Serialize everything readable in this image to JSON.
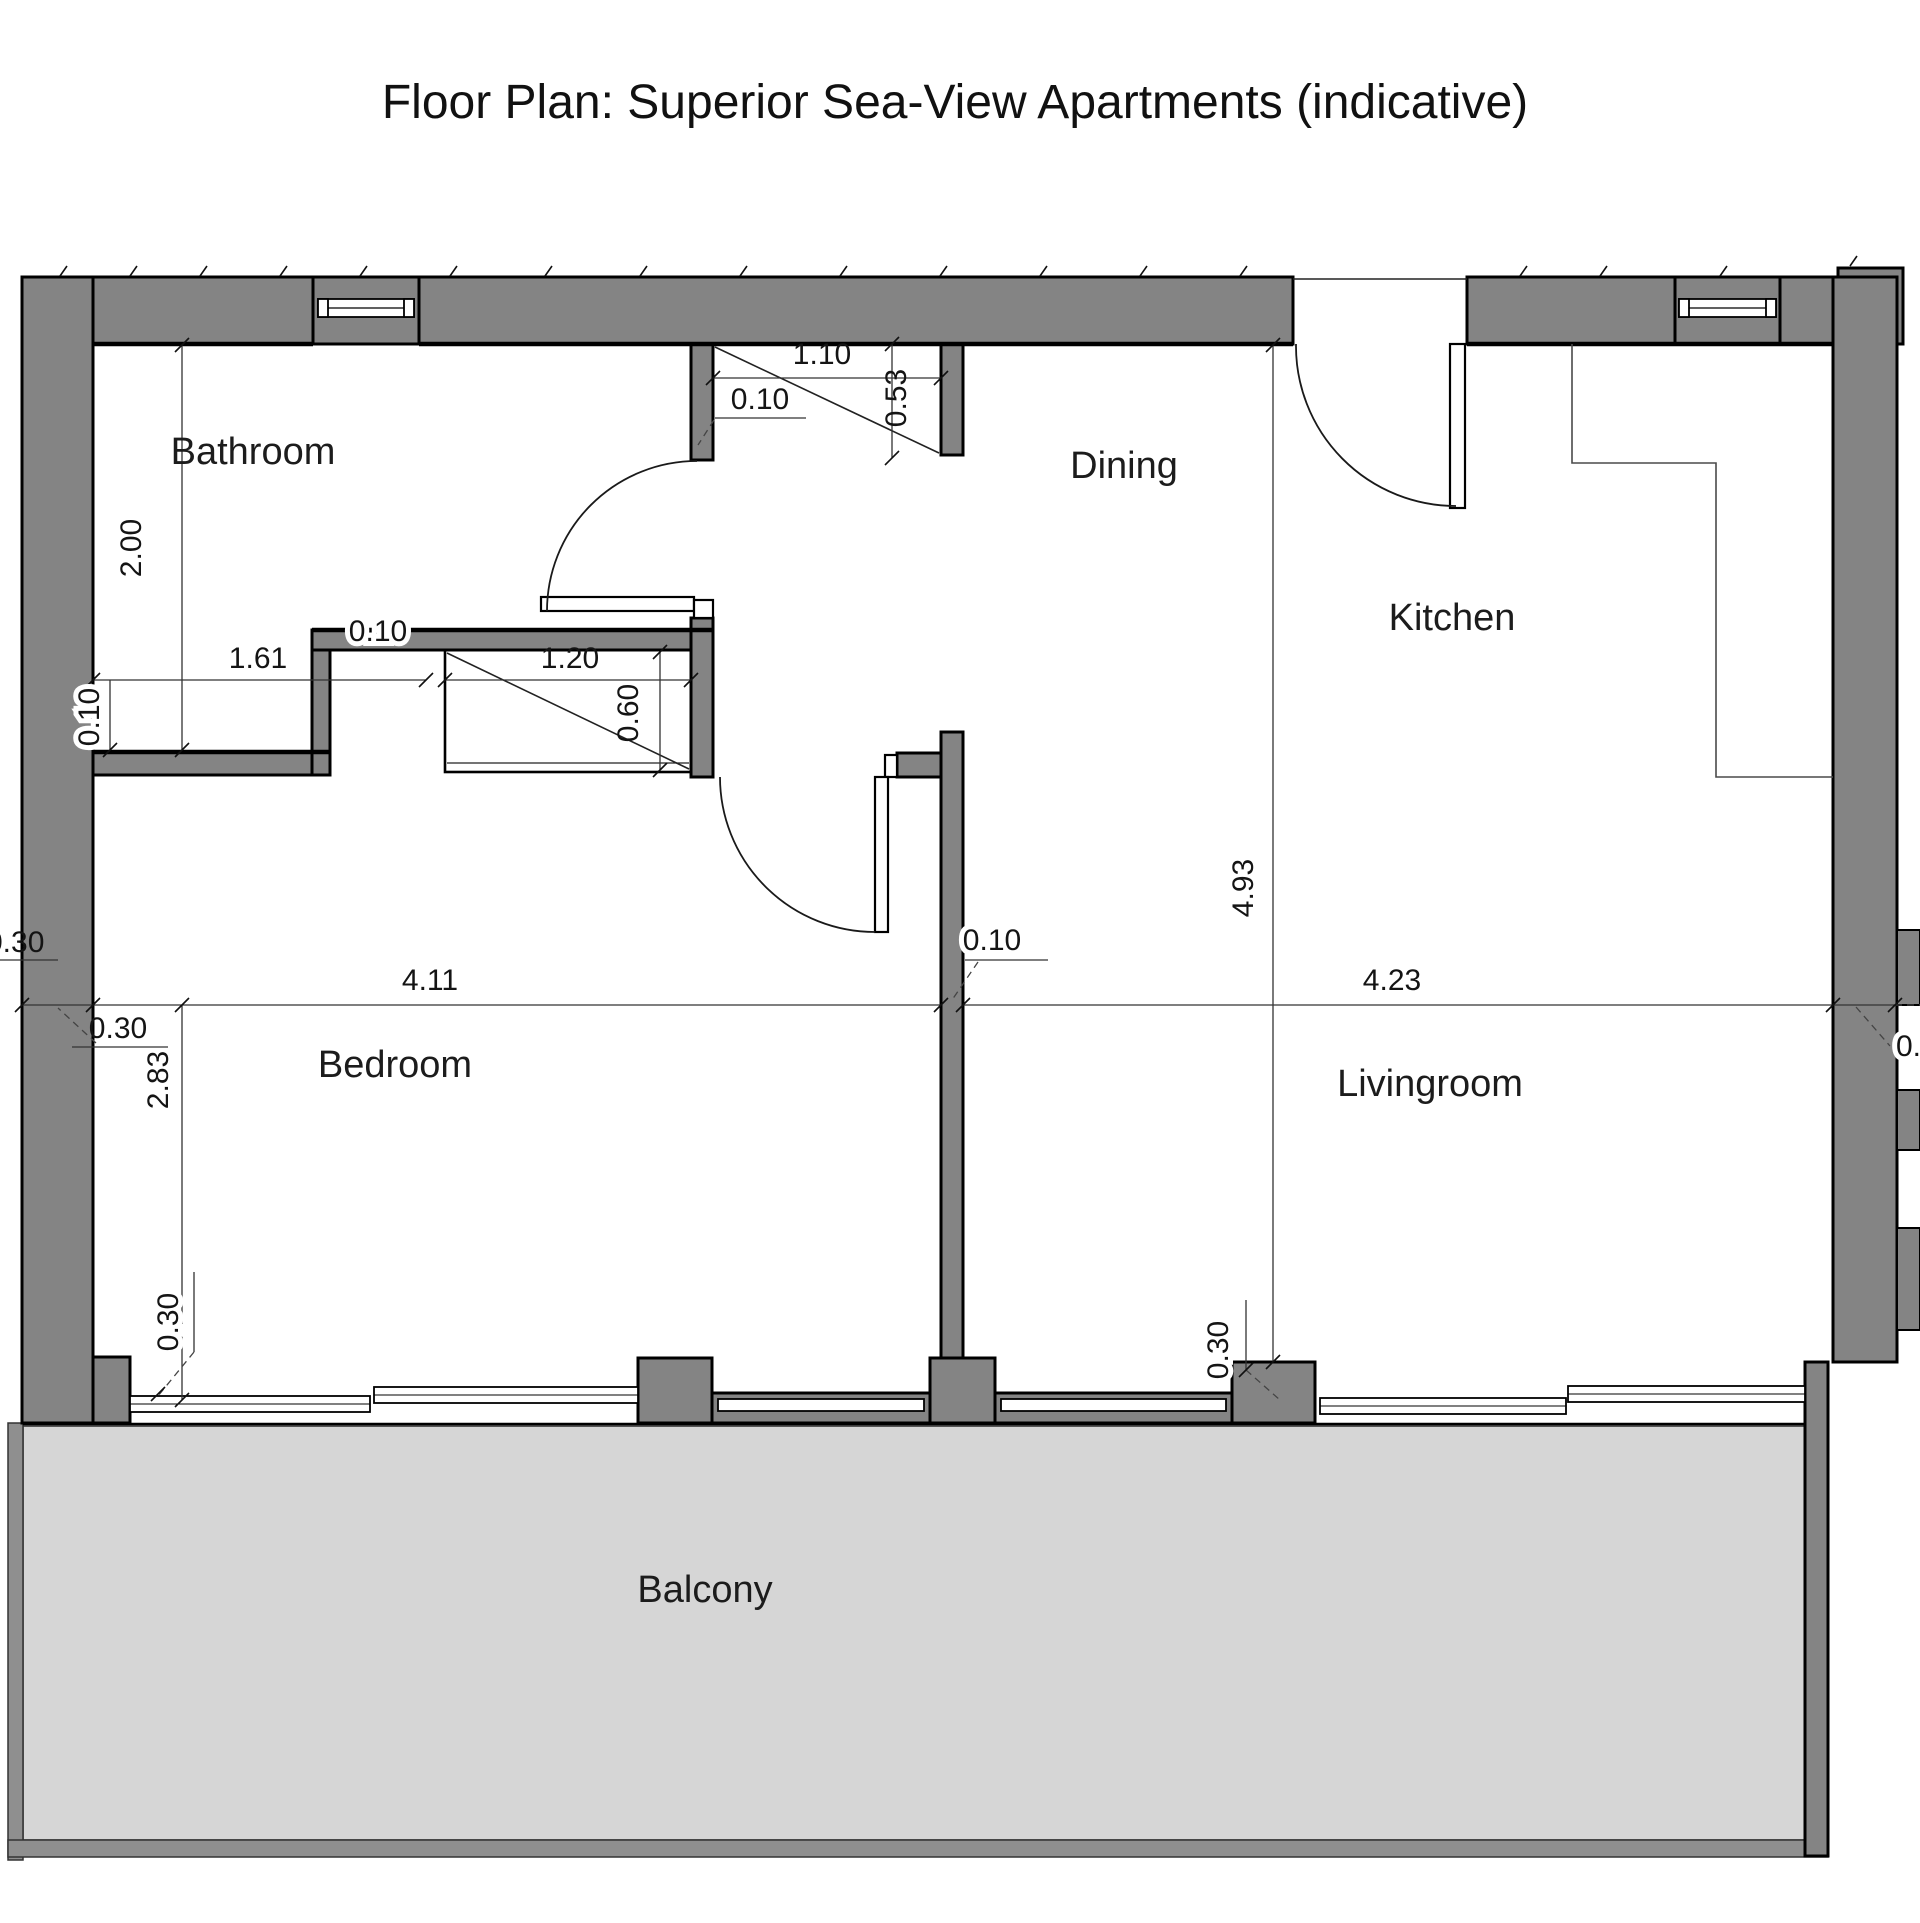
{
  "title": "Floor Plan: Superior Sea-View Apartments (indicative)",
  "colors": {
    "wall": "#848484",
    "balcony_floor": "#d6d6d6",
    "railing": "#8f8f8f",
    "line": "#000000"
  },
  "rooms": {
    "bathroom": {
      "label": "Bathroom"
    },
    "dining": {
      "label": "Dining"
    },
    "kitchen": {
      "label": "Kitchen"
    },
    "bedroom": {
      "label": "Bedroom"
    },
    "livingroom": {
      "label": "Livingroom"
    },
    "balcony": {
      "label": "Balcony"
    }
  },
  "dims": {
    "bath_height": {
      "value": "2.00"
    },
    "bath_width": {
      "value": "1.61"
    },
    "bath_wall": {
      "value": "0.10"
    },
    "niche_wall": {
      "value": "0.10"
    },
    "closet2_width": {
      "value": "1.20"
    },
    "closet2_depth": {
      "value": "0.60"
    },
    "closet1_width": {
      "value": "1.10"
    },
    "closet1_wall": {
      "value": "0.10"
    },
    "closet1_depth": {
      "value": "0.53"
    },
    "inner_wall": {
      "value": "0.10"
    },
    "bedroom_width": {
      "value": "4.11"
    },
    "living_width": {
      "value": "4.23"
    },
    "living_height": {
      "value": "4.93"
    },
    "bedroom_height": {
      "value": "2.83"
    },
    "left_wall": {
      "value": "0.30"
    },
    "left_edge": {
      "value": "0.30"
    },
    "window_offset": {
      "value": "0.30"
    },
    "pier": {
      "value": "0.30"
    },
    "right_edge": {
      "value": "0.10"
    }
  }
}
